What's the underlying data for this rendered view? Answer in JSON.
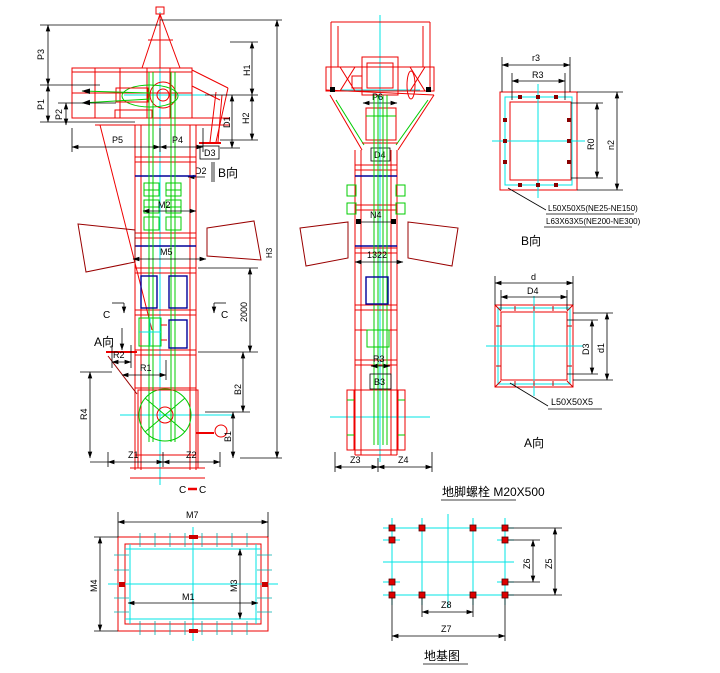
{
  "front_view": {
    "p3": "P3",
    "p1": "P1",
    "p2": "P2",
    "p5": "P5",
    "p4": "P4",
    "h1": "H1",
    "h2": "H2",
    "d1": "D1",
    "d3": "D3",
    "d2": "D2",
    "b_dir": "B向",
    "m2": "M2",
    "m5": "M5",
    "dim_2000": "2000",
    "total_height": "H3",
    "c_section_left": "C",
    "c_section_right": "C",
    "a_dir": "A向",
    "r2": "R2",
    "r1": "R1",
    "r4": "R4",
    "b2": "B2",
    "b1": "B1",
    "z1": "Z1",
    "z2": "Z2"
  },
  "side_view": {
    "p6": "P6",
    "d4": "D4",
    "n4": "N4",
    "dim_1322": "1322",
    "r3": "R3",
    "b3": "B3",
    "z3": "Z3",
    "z4": "Z4"
  },
  "detail_b": {
    "title": "B向",
    "dim_outer_width": "r3",
    "dim_inner_width": "R3",
    "dim_inner_height": "R0",
    "dim_outer_height": "n2",
    "note_line1": "L50X50X5(NE25-NE150)",
    "note_line2": "L63X63X5(NE200-NE300)"
  },
  "detail_a": {
    "title": "A向",
    "dim_outer_width": "d",
    "dim_inner_width": "D4",
    "dim_inner_height": "D3",
    "dim_outer_height": "d1",
    "note": "L50X50X5"
  },
  "section_cc": {
    "title_c1": "C",
    "title_c2": "C",
    "m7": "M7",
    "m4": "M4",
    "m3": "M3",
    "m1": "M1"
  },
  "foundation": {
    "bolt_note": "地脚螺栓 M20X500",
    "title": "地基图",
    "z5": "Z5",
    "z6": "Z6",
    "z7": "Z7",
    "z8": "Z8"
  },
  "colors": {
    "structure": "#ee0000",
    "dark_structure": "#990000",
    "chain": "#00cc00",
    "centerline": "#00e5e5",
    "window": "#000099",
    "dimension": "#000000",
    "background": "#ffffff"
  }
}
